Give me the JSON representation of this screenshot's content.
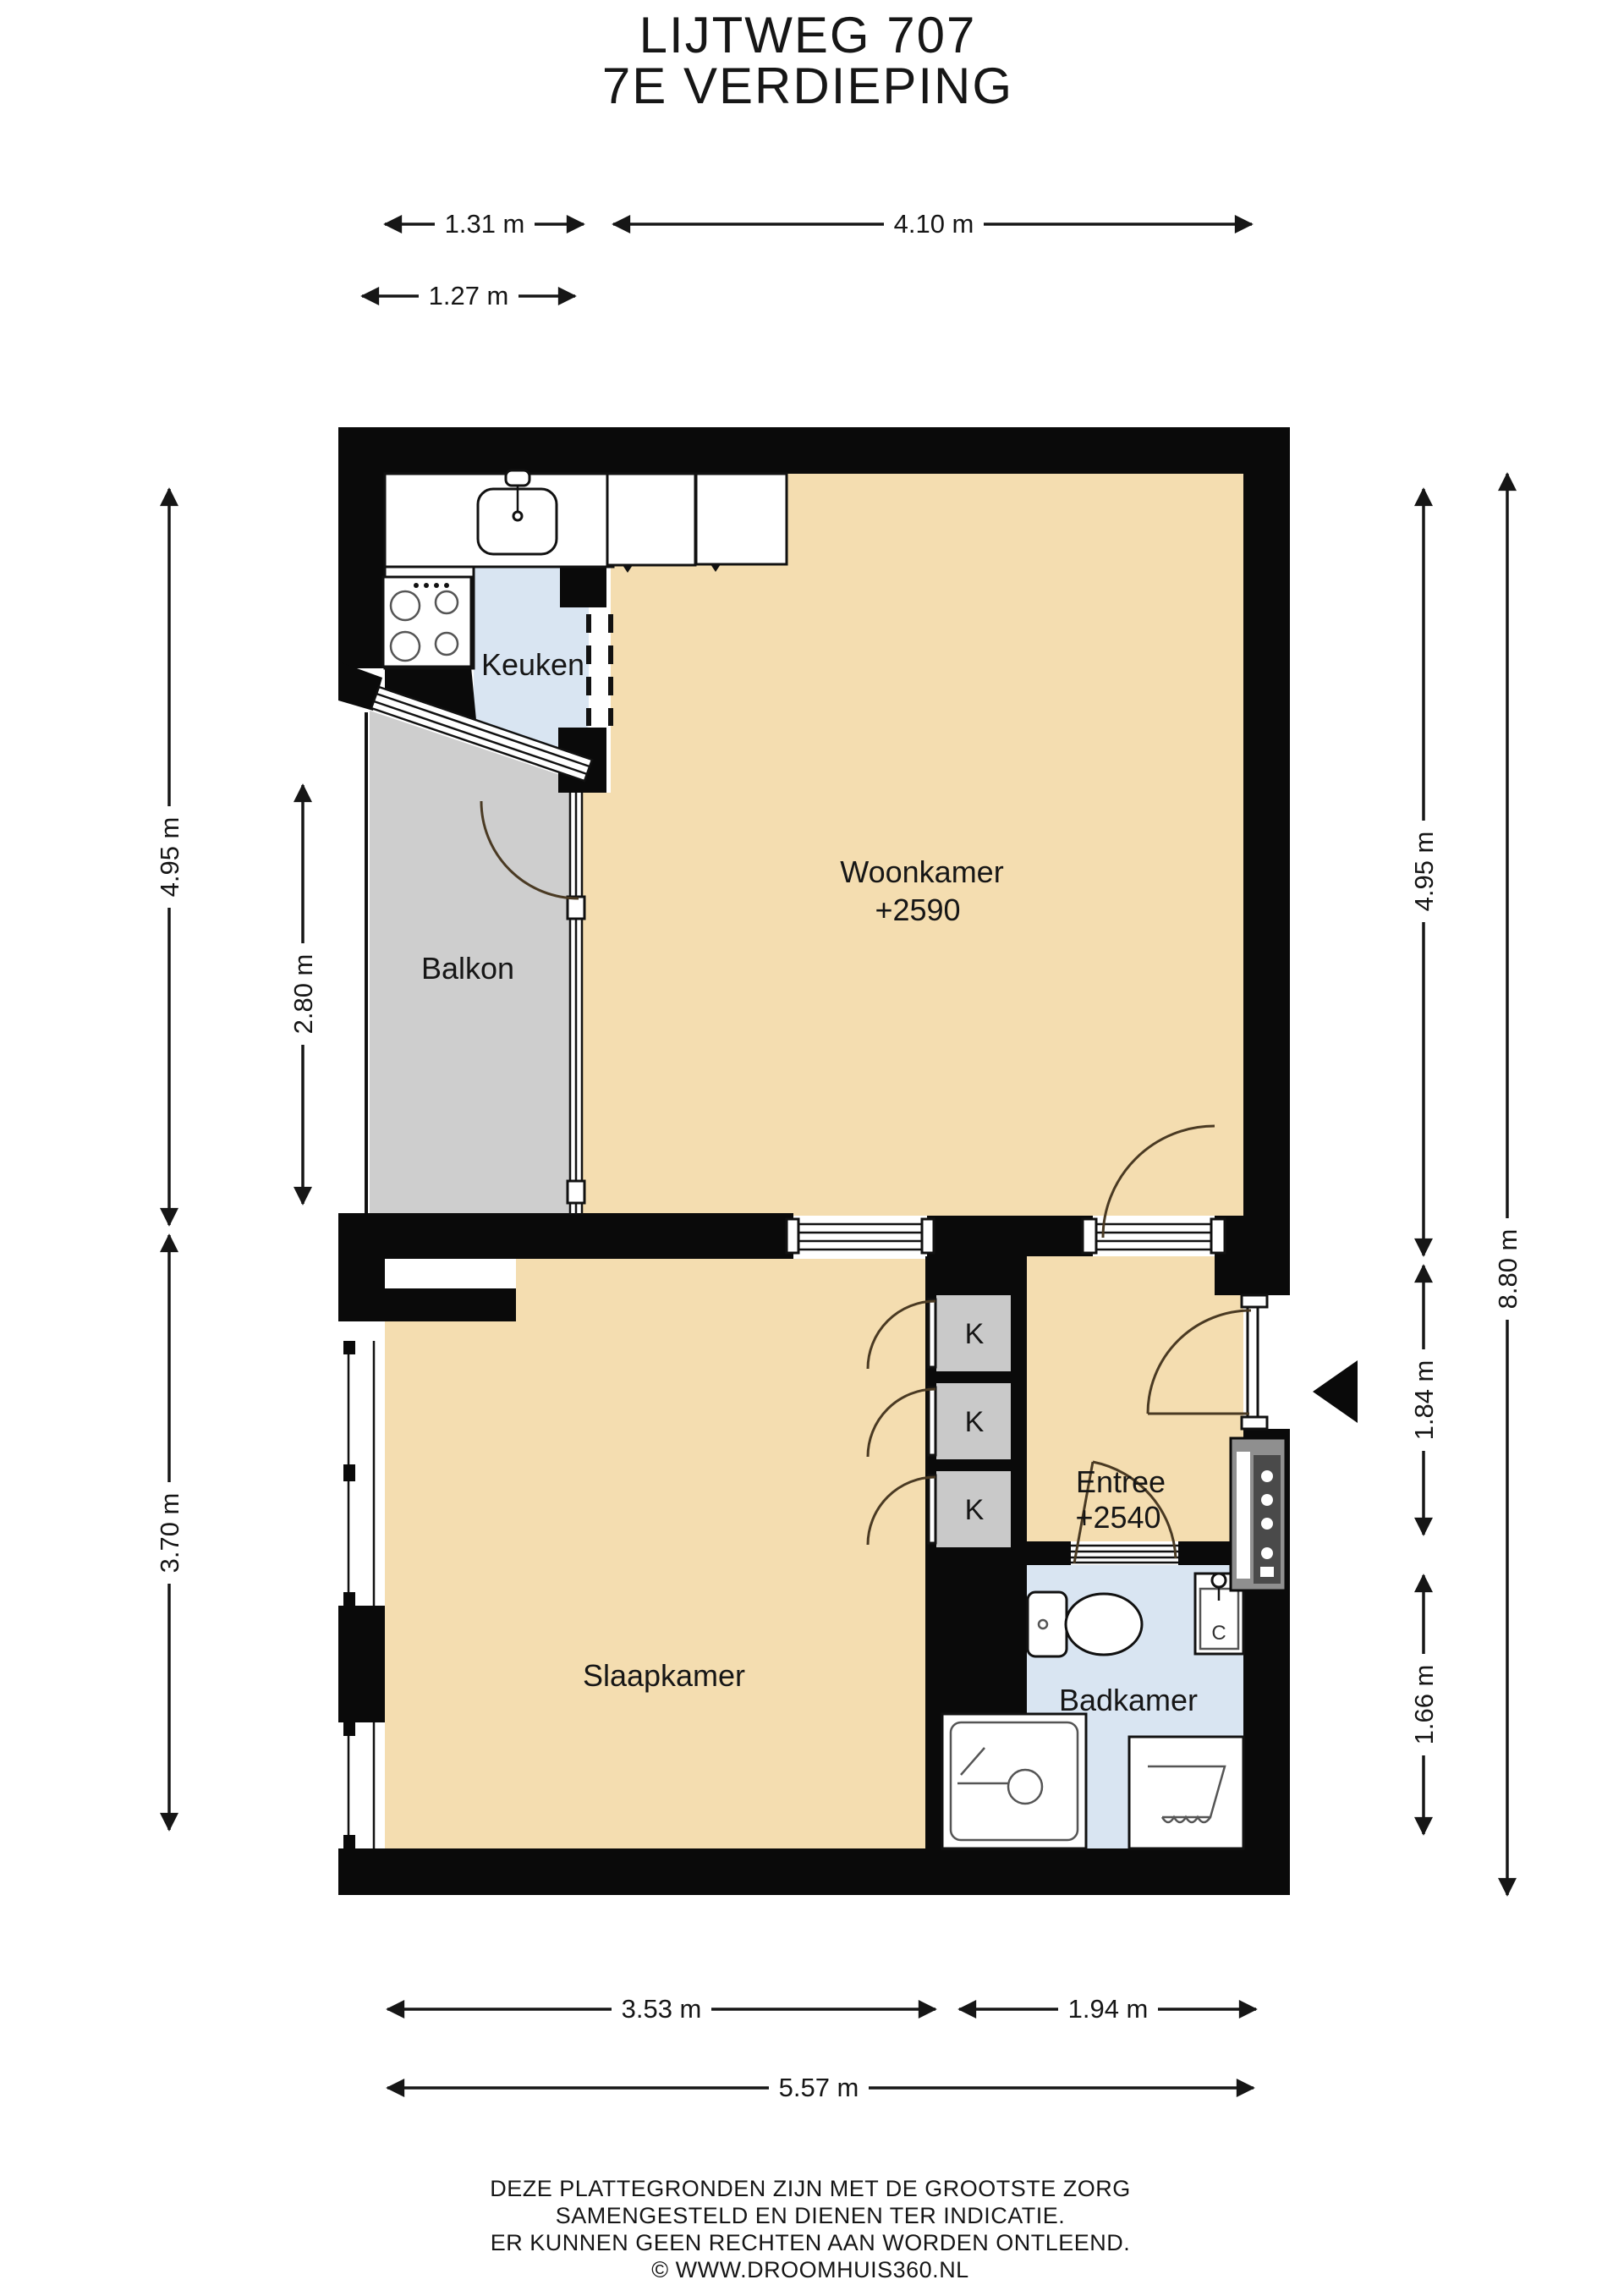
{
  "title": {
    "line1": "LIJTWEG 707",
    "line2": "7E VERDIEPING"
  },
  "rooms": {
    "woonkamer": {
      "name": "Woonkamer",
      "level": "+2590"
    },
    "keuken": {
      "name": "Keuken"
    },
    "balkon": {
      "name": "Balkon"
    },
    "slaapkamer": {
      "name": "Slaapkamer"
    },
    "entree": {
      "name": "Entree",
      "level": "+2540"
    },
    "badkamer": {
      "name": "Badkamer"
    }
  },
  "closets": {
    "label": "K"
  },
  "fixtures": {
    "boiler_label": "C"
  },
  "dimensions": {
    "top": [
      {
        "label": "1.31 m"
      },
      {
        "label": "4.10 m"
      },
      {
        "label": "1.27 m"
      }
    ],
    "left": [
      {
        "label": "4.95 m"
      },
      {
        "label": "2.80 m"
      },
      {
        "label": "3.70 m"
      }
    ],
    "right": [
      {
        "label": "4.95 m"
      },
      {
        "label": "1.84 m"
      },
      {
        "label": "1.66 m"
      },
      {
        "label": "8.80 m"
      }
    ],
    "bottom": [
      {
        "label": "3.53 m"
      },
      {
        "label": "1.94 m"
      },
      {
        "label": "5.57 m"
      }
    ]
  },
  "footer": {
    "lines": [
      "DEZE PLATTEGRONDEN ZIJN MET DE GROOTSTE ZORG",
      "SAMENGESTELD EN DIENEN TER INDICATIE.",
      "ER KUNNEN GEEN RECHTEN AAN WORDEN ONTLEEND.",
      "© WWW.DROOMHUIS360.NL"
    ]
  },
  "colors": {
    "wall_black": "#0a0a0a",
    "floor_tan": "#f4ddb0",
    "floor_blue": "#d9e5f2",
    "balcony_gray": "#cecece",
    "closet_gray": "#c9c9c9"
  }
}
